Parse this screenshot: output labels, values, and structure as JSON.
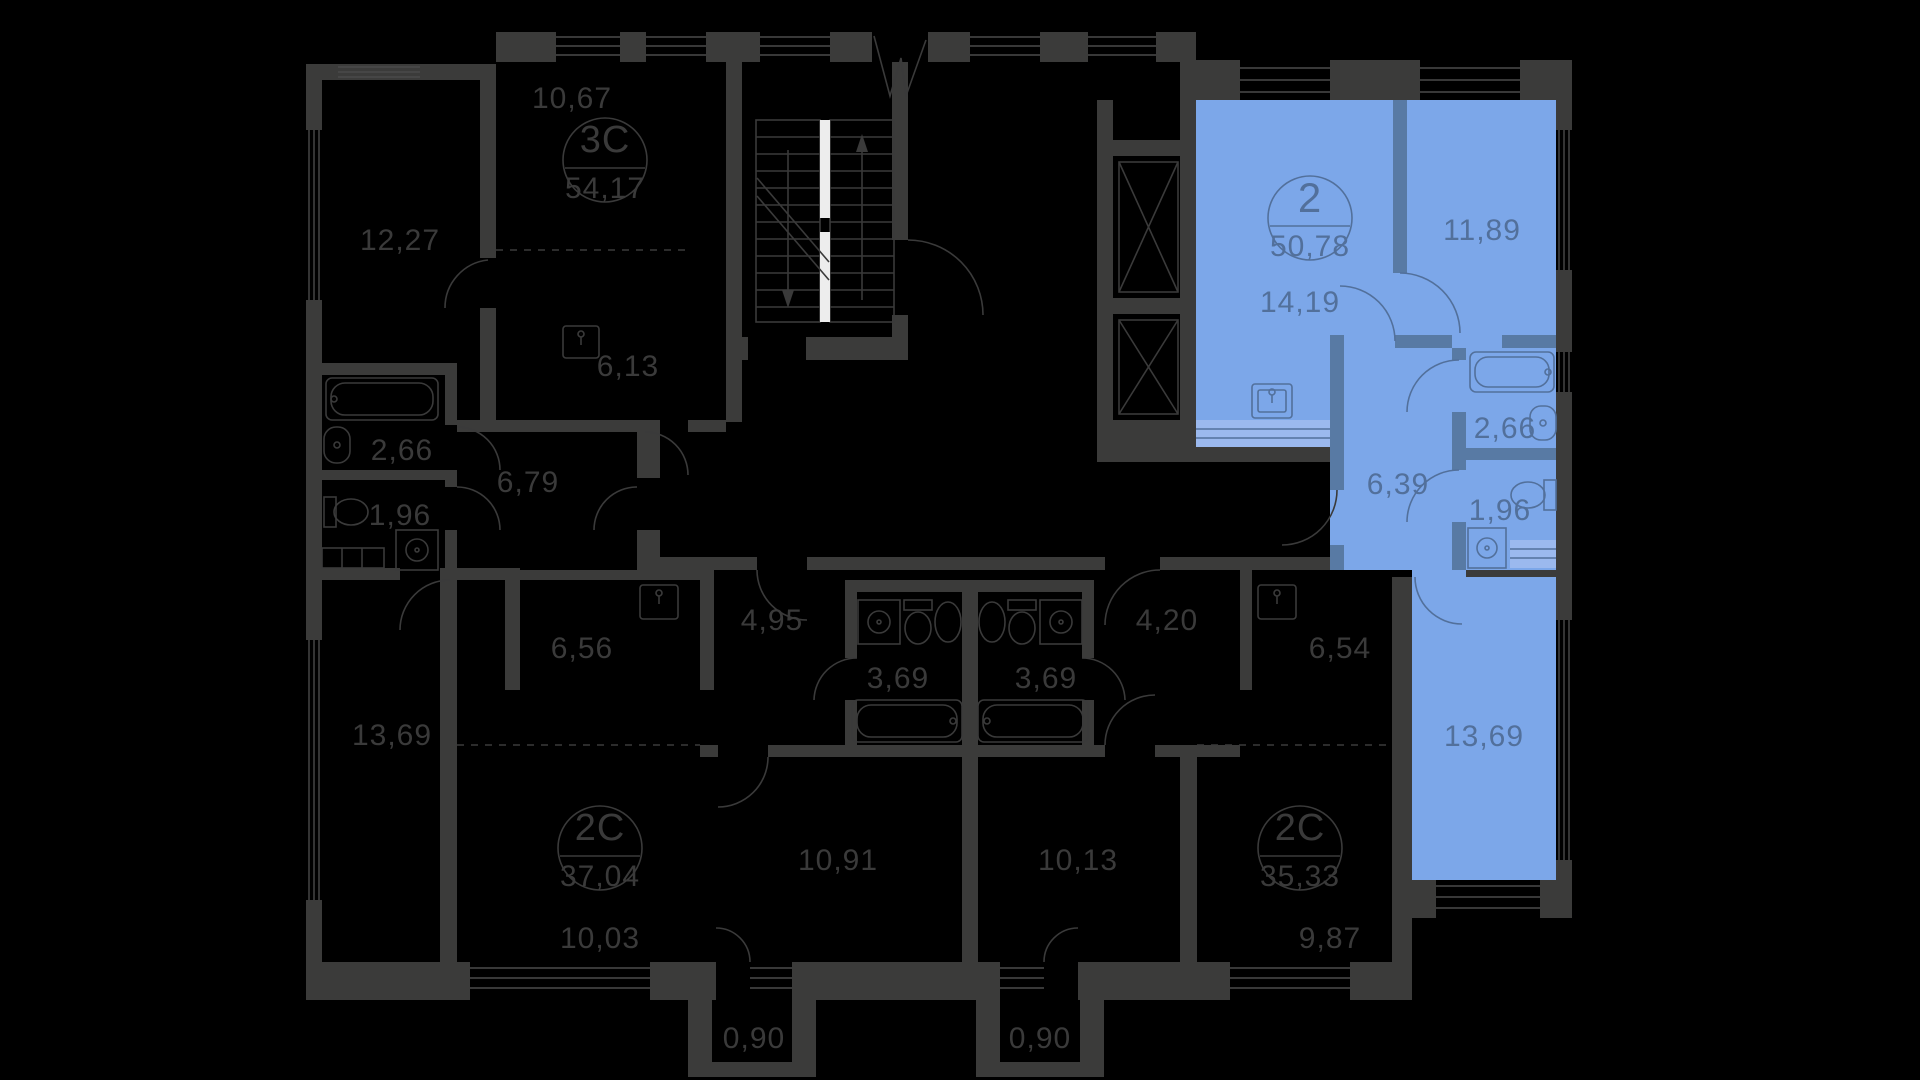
{
  "plan": {
    "colors": {
      "background": "#000000",
      "wall": "#3b3b3a",
      "highlight_fill": "#7ca7e9",
      "highlight_wall": "#587aa4",
      "highlight_text": "#52709b",
      "dark_text": "#3a3a3a"
    },
    "apartments": {
      "left_3c": {
        "type": "3С",
        "total_area": "54,17",
        "rooms": {
          "living": "12,27",
          "kitchen_living": "10,67",
          "kitchen_niche": "6,13",
          "bath": "2,66",
          "wc": "1,96",
          "hall": "6,79",
          "bedroom": "13,69"
        }
      },
      "top_right_2_selected": {
        "type": "2",
        "total_area": "50,78",
        "rooms": {
          "kitchen_living": "14,19",
          "bedroom1": "11,89",
          "bath": "2,66",
          "wc": "1,96",
          "hall": "6,39",
          "bedroom2": "13,69"
        }
      },
      "bottom_left_2c": {
        "type": "2С",
        "total_area": "37,04",
        "rooms": {
          "kitchen": "6,56",
          "hall": "4,95",
          "bath": "3,69",
          "bedroom": "10,91",
          "living": "10,03",
          "balcony": "0,90"
        }
      },
      "bottom_right_2c": {
        "type": "2С",
        "total_area": "35,33",
        "rooms": {
          "bath": "3,69",
          "hall": "4,20",
          "kitchen": "6,54",
          "bedroom": "10,13",
          "living": "9,87",
          "balcony": "0,90"
        }
      }
    }
  }
}
